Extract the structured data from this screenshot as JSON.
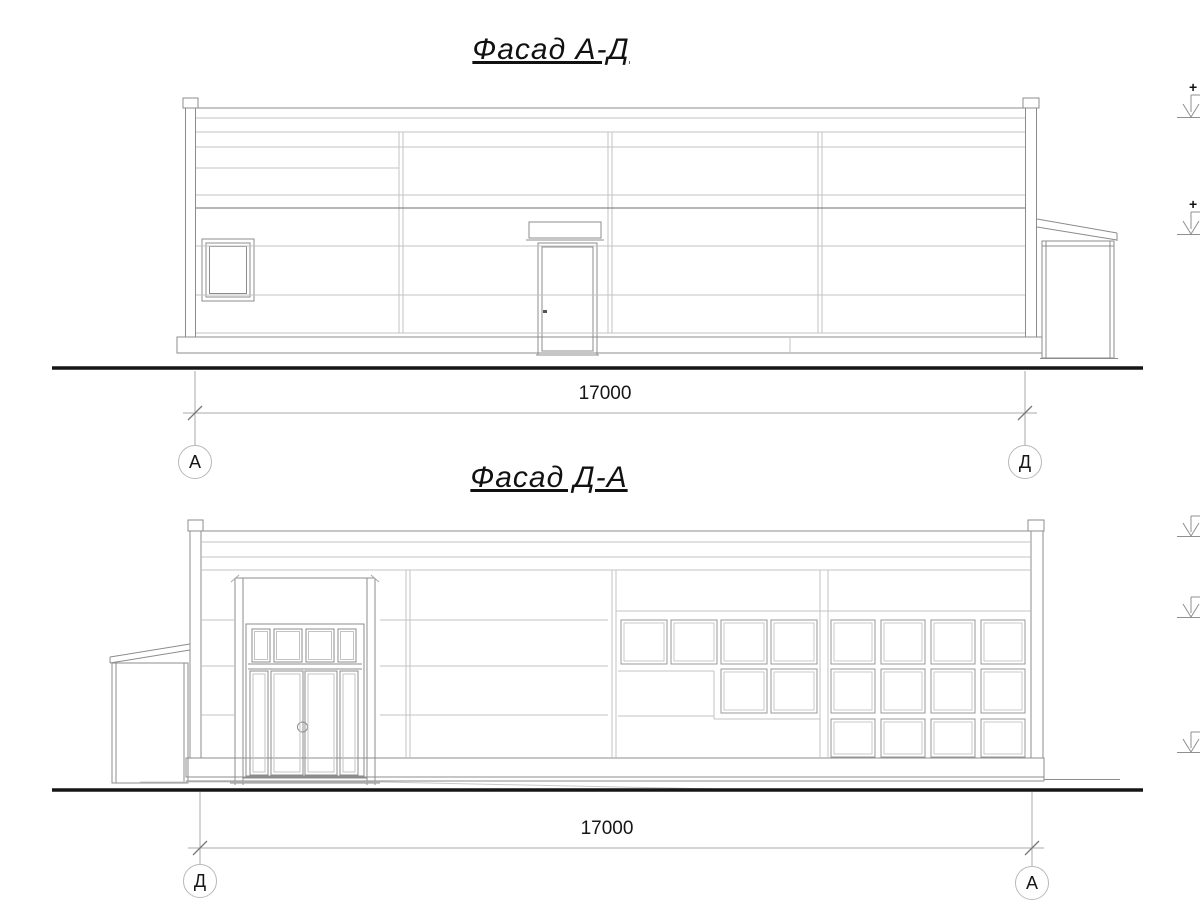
{
  "drawing": {
    "facade_top": {
      "title": "Фасад А-Д",
      "dimension": "17000",
      "axis_left": "А",
      "axis_right": "Д",
      "elevation_plus_1": "+",
      "elevation_plus_2": "+"
    },
    "facade_bottom": {
      "title": "Фасад Д-А",
      "dimension": "17000",
      "axis_left": "Д",
      "axis_right": "А"
    }
  },
  "colors": {
    "background": "#ffffff",
    "line_main": "#8c8c8c",
    "line_light": "#c3c3c3",
    "line_accent": "#6f6f6f",
    "ground_line": "#161616",
    "text": "#111111"
  }
}
